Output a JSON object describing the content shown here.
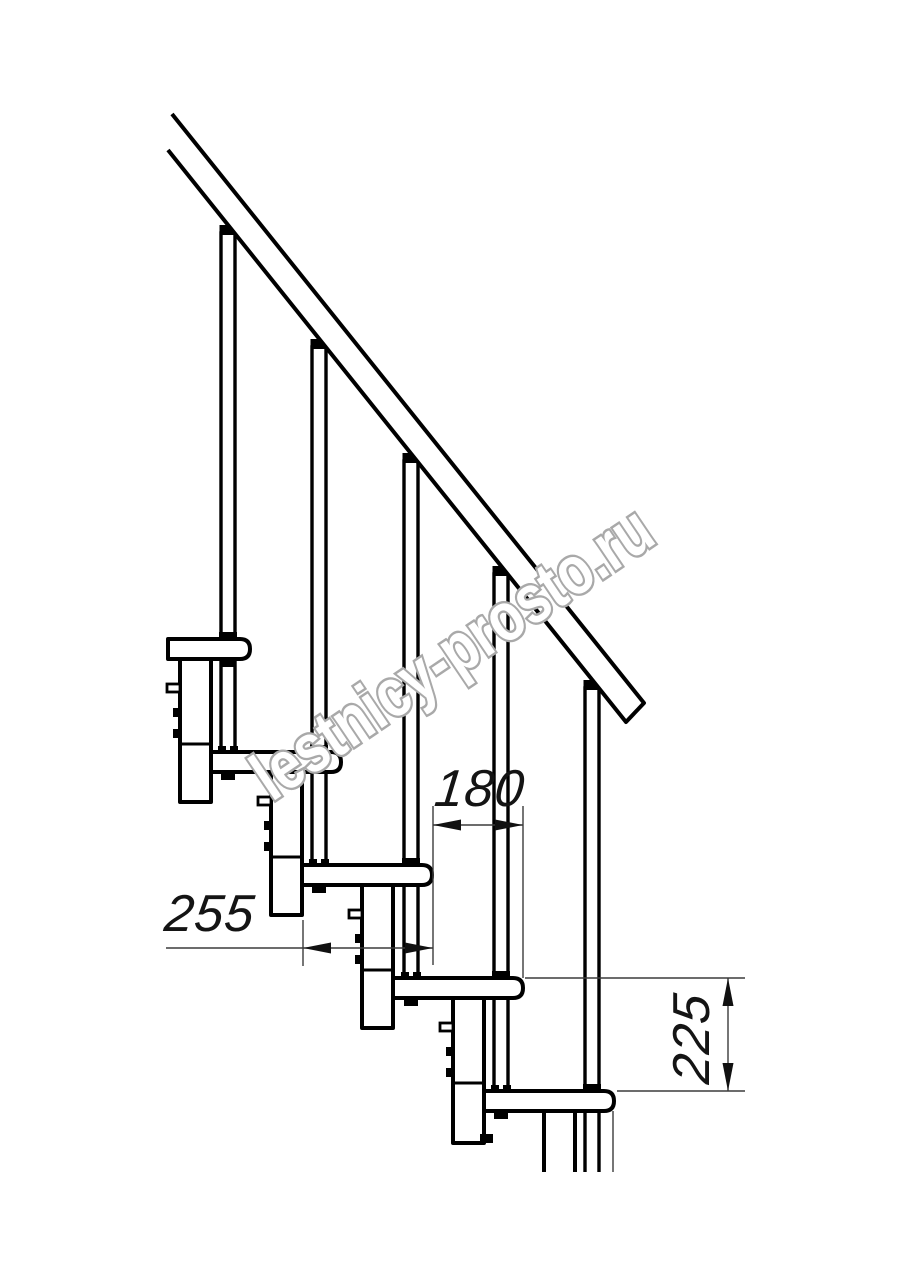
{
  "watermark": {
    "text": "lestnicy-prosto.ru"
  },
  "dimensions": {
    "run_label": "180",
    "tread_depth_label": "255",
    "rise_label": "225"
  },
  "drawing": {
    "tread_count": 5,
    "baluster_count": 5
  }
}
